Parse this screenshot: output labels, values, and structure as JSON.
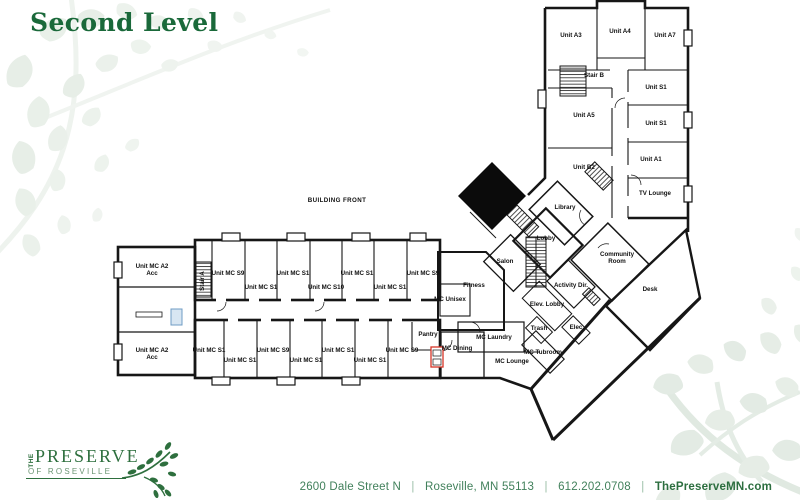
{
  "title": "Second Level",
  "plan": {
    "rooms": [
      {
        "label": "Unit A3",
        "x": 571,
        "y": 37
      },
      {
        "label": "Unit A4",
        "x": 620,
        "y": 33
      },
      {
        "label": "Unit A7",
        "x": 665,
        "y": 37
      },
      {
        "label": "Stair B",
        "x": 594,
        "y": 77,
        "s": 5.8
      },
      {
        "label": "Unit S1",
        "x": 656,
        "y": 89
      },
      {
        "label": "Unit A5",
        "x": 584,
        "y": 117
      },
      {
        "label": "Unit S1",
        "x": 656,
        "y": 125
      },
      {
        "label": "Unit A1",
        "x": 651,
        "y": 161
      },
      {
        "label": "Unit B2",
        "x": 584,
        "y": 169
      },
      {
        "label": "TV Lounge",
        "x": 655,
        "y": 195
      },
      {
        "label": "Library",
        "x": 565,
        "y": 209
      },
      {
        "label": "Lobby",
        "x": 546,
        "y": 240
      },
      {
        "label": "Salon",
        "x": 505,
        "y": 263
      },
      {
        "label": "Fitness",
        "x": 474,
        "y": 287
      },
      {
        "label": "MC Unisex",
        "x": 450,
        "y": 301
      },
      {
        "label": [
          "Community",
          "Room"
        ],
        "x": 617,
        "y": 256
      },
      {
        "label": "Activity Dir.",
        "x": 571,
        "y": 287
      },
      {
        "label": "Desk",
        "x": 650,
        "y": 291
      },
      {
        "label": "Elev. Lobby",
        "x": 547,
        "y": 306
      },
      {
        "label": "Trash",
        "x": 539,
        "y": 330
      },
      {
        "label": "Elec",
        "x": 576,
        "y": 329
      },
      {
        "label": "MC Laundry",
        "x": 494,
        "y": 339
      },
      {
        "label": "MC Tubroom",
        "x": 543,
        "y": 354
      },
      {
        "label": "MC Lounge",
        "x": 512,
        "y": 363
      },
      {
        "label": "MC Dining",
        "x": 457,
        "y": 350
      },
      {
        "label": "Pantry",
        "x": 428,
        "y": 336
      },
      {
        "label": [
          "Unit MC A2",
          "Acc"
        ],
        "x": 152,
        "y": 268
      },
      {
        "label": "Stair A",
        "x": 204,
        "y": 281,
        "r": -90,
        "s": 5.8
      },
      {
        "label": "Unit MC S9",
        "x": 228,
        "y": 275
      },
      {
        "label": "Unit MC S1",
        "x": 261,
        "y": 289
      },
      {
        "label": "Unit MC S1",
        "x": 293,
        "y": 275
      },
      {
        "label": "Unit MC S10",
        "x": 326,
        "y": 289
      },
      {
        "label": "Unit MC S1",
        "x": 357,
        "y": 275
      },
      {
        "label": "Unit MC S1",
        "x": 390,
        "y": 289
      },
      {
        "label": "Unit MC S9",
        "x": 423,
        "y": 275
      },
      {
        "label": [
          "Unit MC A2",
          "Acc"
        ],
        "x": 152,
        "y": 352
      },
      {
        "label": "Unit MC S1",
        "x": 209,
        "y": 352
      },
      {
        "label": "Unit MC S1",
        "x": 240,
        "y": 362
      },
      {
        "label": "Unit MC S9",
        "x": 273,
        "y": 352
      },
      {
        "label": "Unit MC S1",
        "x": 306,
        "y": 362
      },
      {
        "label": "Unit MC S1",
        "x": 338,
        "y": 352
      },
      {
        "label": "Unit MC S1",
        "x": 370,
        "y": 362
      },
      {
        "label": "Unit MC S9",
        "x": 402,
        "y": 352
      },
      {
        "label": "BUILDING FRONT",
        "x": 337,
        "y": 202,
        "s": 7.6,
        "sp": 0.4
      }
    ]
  },
  "logo": {
    "the": "THE",
    "name": "PRESERVE",
    "of": "OF ROSEVILLE"
  },
  "footer": {
    "address": "2600 Dale Street N",
    "city": "Roseville, MN 55113",
    "phone": "612.202.0708",
    "website": "ThePreserveMN.com",
    "sep": "|"
  },
  "colors": {
    "heading_green": "#1a693a",
    "footer_green": "#3f7d54",
    "logo_green": "#2e6f3e",
    "leaf_tint": "#e8efe8",
    "wall_black": "#161616",
    "elevator_red": "#d63427",
    "door_blue": "#8fb6d4"
  }
}
